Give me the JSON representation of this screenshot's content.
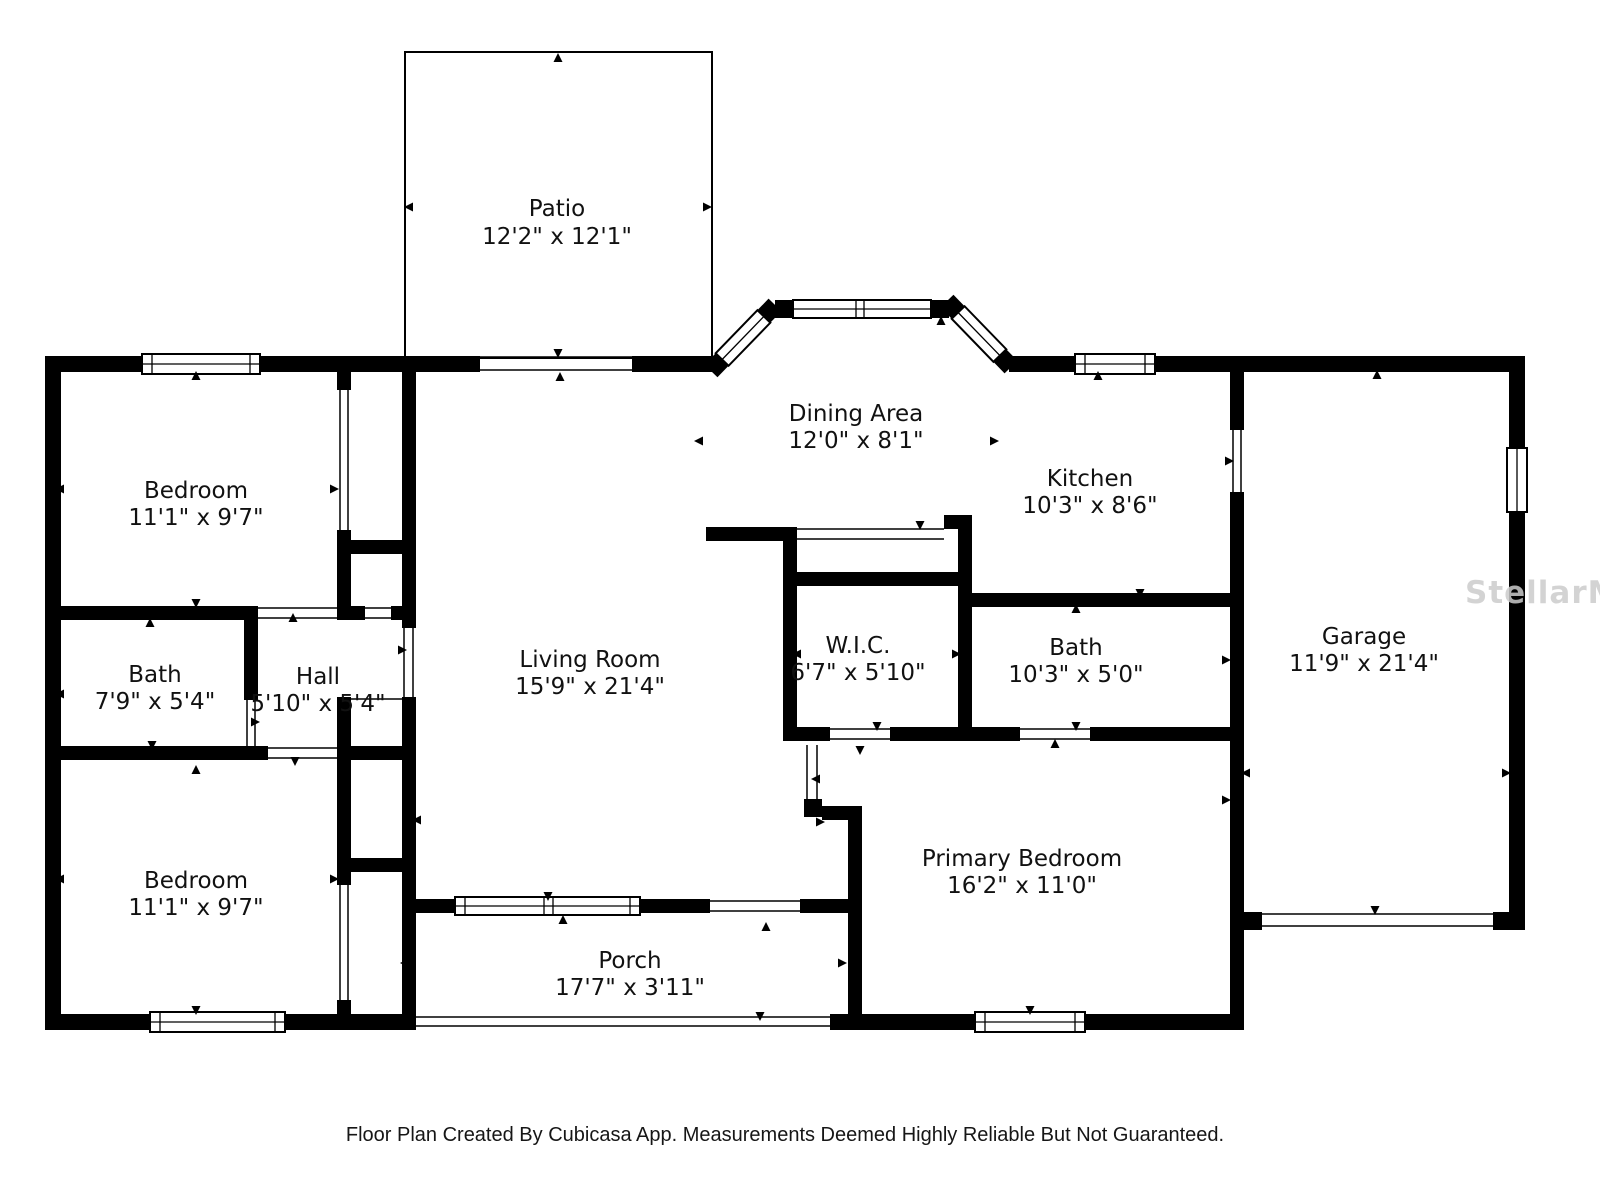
{
  "watermark": "StellarMLS",
  "footer": "Floor Plan Created By Cubicasa App. Measurements Deemed Highly Reliable But Not Guaranteed.",
  "rooms": {
    "patio": {
      "name": "Patio",
      "dims": "12'2\" x 12'1\""
    },
    "dining": {
      "name": "Dining Area",
      "dims": "12'0\" x 8'1\""
    },
    "kitchen": {
      "name": "Kitchen",
      "dims": "10'3\" x 8'6\""
    },
    "bedroom_top": {
      "name": "Bedroom",
      "dims": "11'1\" x 9'7\""
    },
    "bath_left": {
      "name": "Bath",
      "dims": "7'9\" x 5'4\""
    },
    "hall": {
      "name": "Hall",
      "dims": "5'10\" x 5'4\""
    },
    "living": {
      "name": "Living Room",
      "dims": "15'9\" x 21'4\""
    },
    "wic": {
      "name": "W.I.C.",
      "dims": "6'7\" x 5'10\""
    },
    "bath_right": {
      "name": "Bath",
      "dims": "10'3\" x 5'0\""
    },
    "garage": {
      "name": "Garage",
      "dims": "11'9\" x 21'4\""
    },
    "bedroom_bottom": {
      "name": "Bedroom",
      "dims": "11'1\" x 9'7\""
    },
    "primary": {
      "name": "Primary Bedroom",
      "dims": "16'2\" x 11'0\""
    },
    "porch": {
      "name": "Porch",
      "dims": "17'7\" x 3'11\""
    }
  }
}
